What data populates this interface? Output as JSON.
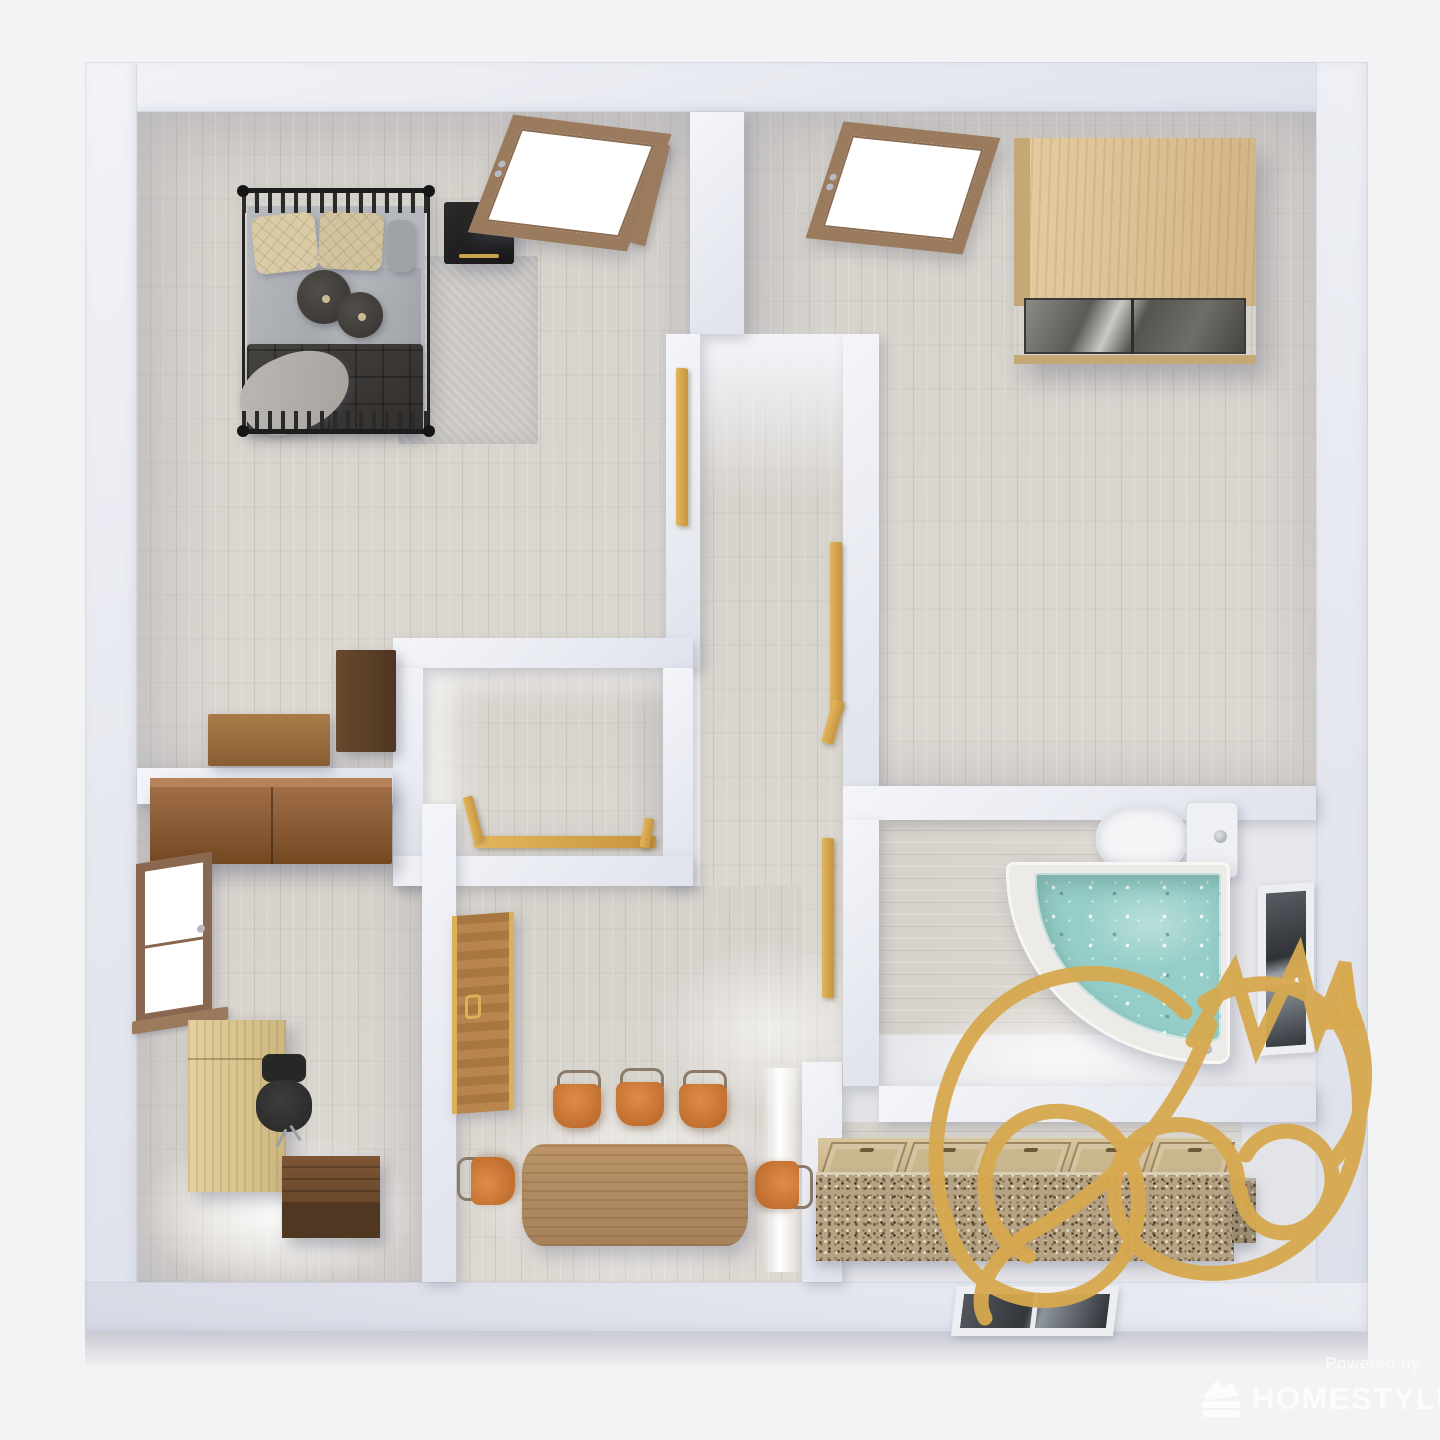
{
  "scene": {
    "description": "3D top-down render of an apartment floor plan",
    "background": "#f3f3f5",
    "palette": {
      "outer_wall": "#e9ebf1",
      "inner_wall": "#eceef3",
      "floor_plank": "#d7d3cd",
      "watermark_gold": "#d7a94f",
      "handrail_gold": "#d9a84e",
      "bed_duvet": "#3b3a37",
      "pillow_beige": "#d8cba6",
      "chair_orange": "#d9803e",
      "oak_wood": "#d9c08f",
      "walnut_wood": "#6b4a2e",
      "tub_water": "#95cec8",
      "granite": "#b5a385",
      "branding_text": "#fbfcfd"
    }
  },
  "branding": {
    "powered_by": "Powered by",
    "wordmark": "HOMESTYLER",
    "logo_icon": "homestyler-fan-icon",
    "watermark_icon": "crowned-swirl-watermark"
  },
  "rooms": {
    "bedroom": {
      "furniture": [
        "double-bed",
        "black-nightstand",
        "area-rug",
        "storage-chest",
        "dark-side-table",
        "glass-panel-door"
      ]
    },
    "closet_room": {
      "furniture": [
        "oak-wardrobe-glass-front",
        "glass-panel-door"
      ]
    },
    "hallway": {
      "furniture": [
        "stair-handrails",
        "stairwell-railing"
      ]
    },
    "office": {
      "furniture": [
        "dark-wall-cabinet",
        "wood-framed-window",
        "oak-desk",
        "office-chair",
        "walnut-bench"
      ]
    },
    "dining_room": {
      "furniture": [
        "wood-door-gold-trim",
        "dining-table",
        "orange-chair-x5"
      ]
    },
    "bathroom": {
      "furniture": [
        "toilet",
        "corner-tub-filled",
        "wall-window"
      ]
    },
    "kitchen": {
      "furniture": [
        "granite-counter",
        "cabinet-door-row",
        "bottom-wall-window"
      ]
    }
  }
}
